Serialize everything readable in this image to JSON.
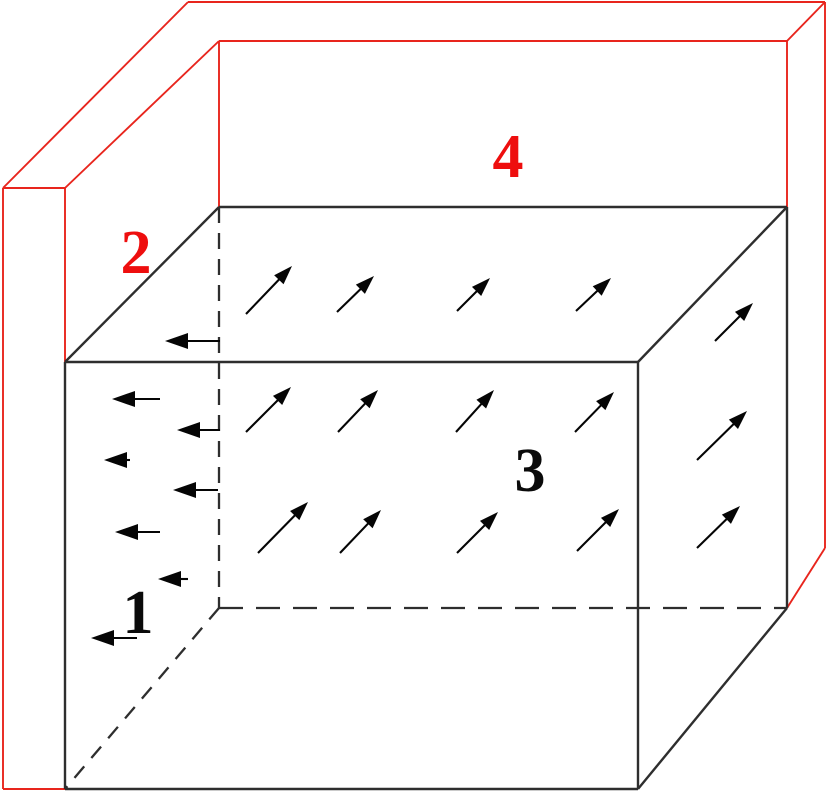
{
  "figure": {
    "description": "3D schematic of a rectangular box (cuboid) with outward flux arrows on its top, front and right faces, leftward arrows on its left region, enclosed by an L-shaped red wall (left slab and back slab). Surfaces are numbered 1-4.",
    "canvas": {
      "width": 828,
      "height": 792,
      "background": "#ffffff"
    },
    "colors": {
      "wall_red": "#e8251d",
      "label_red": "#ee0e0e",
      "box_black": "#2e2e2e",
      "arrow_black": "#050505",
      "label_black": "#0a0a0a"
    },
    "labels": [
      {
        "name": "surface-label-1",
        "text": "1",
        "x": 138,
        "y": 633,
        "color": "label_black"
      },
      {
        "name": "surface-label-2",
        "text": "2",
        "x": 136,
        "y": 273,
        "color": "label_red"
      },
      {
        "name": "surface-label-3",
        "text": "3",
        "x": 530,
        "y": 491,
        "color": "label_black"
      },
      {
        "name": "surface-label-4",
        "text": "4",
        "x": 508,
        "y": 177,
        "color": "label_red"
      }
    ],
    "red_wall_lines": [
      {
        "name": "back-wall-top-outer-edge",
        "pts": [
          188,
          2,
          825,
          2
        ]
      },
      {
        "name": "back-wall-top-inner-edge",
        "pts": [
          219,
          41,
          787,
          41
        ]
      },
      {
        "name": "left-wall-top-outer-edge",
        "pts": [
          188,
          2,
          3,
          188
        ]
      },
      {
        "name": "left-wall-top-inner-edge",
        "pts": [
          219,
          41,
          65,
          188
        ]
      },
      {
        "name": "left-wall-top-front-edge",
        "pts": [
          3,
          188,
          65,
          188
        ]
      },
      {
        "name": "left-wall-front-outer-edge",
        "pts": [
          3,
          188,
          3,
          789
        ]
      },
      {
        "name": "left-wall-front-inner-edge",
        "pts": [
          65,
          188,
          65,
          362
        ]
      },
      {
        "name": "left-wall-bottom-edge",
        "pts": [
          3,
          789,
          65,
          789
        ]
      },
      {
        "name": "wall-inner-corner-edge",
        "pts": [
          219,
          41,
          219,
          207
        ]
      },
      {
        "name": "back-wall-right-corner-edge",
        "pts": [
          825,
          2,
          787,
          41
        ]
      },
      {
        "name": "back-wall-right-outer-edge",
        "pts": [
          825,
          2,
          825,
          548
        ]
      },
      {
        "name": "back-wall-right-inner-edge",
        "pts": [
          787,
          41,
          787,
          207
        ]
      },
      {
        "name": "back-wall-right-bottom-edge",
        "pts": [
          825,
          548,
          787,
          608
        ]
      }
    ],
    "box_solid_lines": [
      {
        "name": "box-back-top-edge",
        "pts": [
          219,
          207,
          787,
          207
        ]
      },
      {
        "name": "box-top-left-edge",
        "pts": [
          219,
          207,
          65,
          362
        ]
      },
      {
        "name": "box-top-right-edge",
        "pts": [
          787,
          207,
          638,
          362
        ]
      },
      {
        "name": "box-front-top-edge",
        "pts": [
          65,
          362,
          638,
          362
        ]
      },
      {
        "name": "box-front-left-edge",
        "pts": [
          65,
          362,
          65,
          789
        ]
      },
      {
        "name": "box-front-right-edge",
        "pts": [
          638,
          362,
          638,
          789
        ]
      },
      {
        "name": "box-front-bottom-edge",
        "pts": [
          65,
          789,
          638,
          789
        ]
      },
      {
        "name": "box-back-right-edge",
        "pts": [
          787,
          207,
          787,
          608
        ]
      },
      {
        "name": "box-bottom-right-edge",
        "pts": [
          787,
          608,
          638,
          789
        ]
      }
    ],
    "box_dashed_lines": [
      {
        "name": "box-hidden-back-left-edge",
        "pts": [
          219,
          207,
          219,
          608
        ],
        "dash": "16 10"
      },
      {
        "name": "box-hidden-back-bottom-edge",
        "pts": [
          219,
          608,
          787,
          608
        ],
        "dash": "24 13"
      },
      {
        "name": "box-hidden-bottom-left-edge",
        "pts": [
          219,
          608,
          65,
          789
        ],
        "dash": "15 11"
      }
    ],
    "arrow_groups": [
      {
        "name": "top-face-outward-arrows",
        "head_len": 19,
        "head_halfwidth": 6.5,
        "arrows": [
          [
            246,
            314,
            292,
            266
          ],
          [
            337,
            312,
            374,
            276
          ],
          [
            457,
            311,
            490,
            278
          ],
          [
            576,
            311,
            611,
            278
          ]
        ]
      },
      {
        "name": "front-face-outward-arrows",
        "head_len": 19,
        "head_halfwidth": 6.5,
        "arrows": [
          [
            246,
            432,
            291,
            387
          ],
          [
            338,
            432,
            378,
            390
          ],
          [
            456,
            432,
            494,
            390
          ],
          [
            575,
            432,
            614,
            392
          ],
          [
            258,
            553,
            308,
            502
          ],
          [
            340,
            553,
            381,
            510
          ],
          [
            457,
            553,
            498,
            512
          ],
          [
            577,
            551,
            619,
            509
          ]
        ]
      },
      {
        "name": "right-face-outward-arrows",
        "head_len": 19,
        "head_halfwidth": 6.5,
        "arrows": [
          [
            715,
            341,
            753,
            303
          ],
          [
            697,
            460,
            747,
            411
          ],
          [
            697,
            548,
            740,
            506
          ]
        ]
      },
      {
        "name": "leftward-arrows",
        "head_len": 23,
        "head_halfwidth": 8,
        "arrows": [
          [
            220,
            341,
            165,
            341
          ],
          [
            160,
            399,
            112,
            399
          ],
          [
            220,
            430,
            177,
            430
          ],
          [
            130,
            460,
            104,
            460
          ],
          [
            218,
            490,
            173,
            490
          ],
          [
            160,
            532,
            115,
            532
          ],
          [
            188,
            579,
            158,
            579
          ],
          [
            137,
            638,
            91,
            638
          ]
        ]
      }
    ],
    "stroke_widths": {
      "wall": 1.9,
      "box": 2.4,
      "dashed": 2.3,
      "arrow_shaft": 2.1
    }
  }
}
